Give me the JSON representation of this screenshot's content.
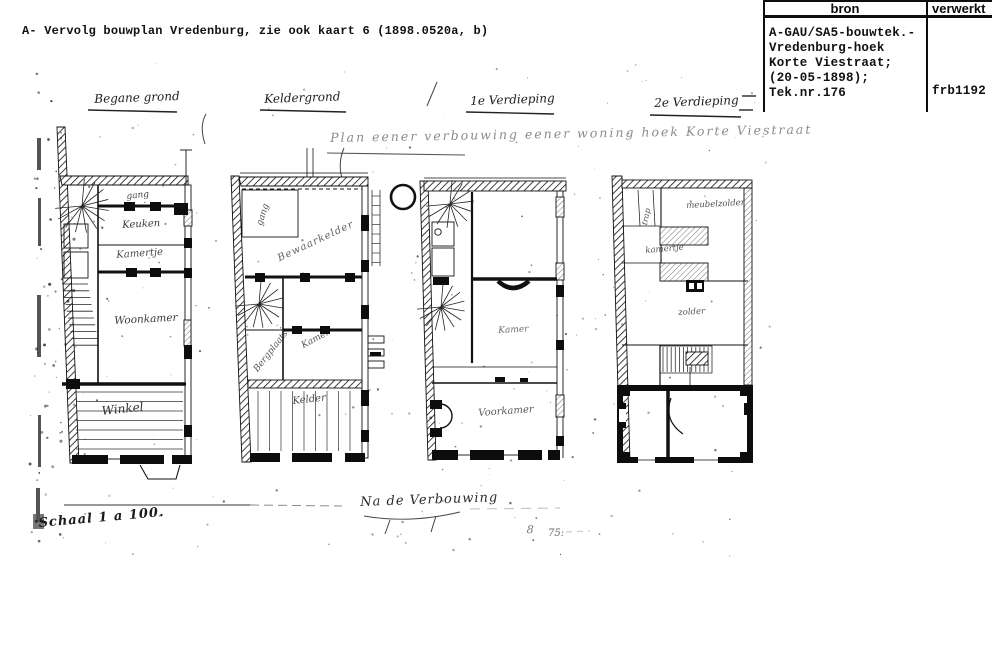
{
  "page": {
    "note": "A- Vervolg bouwplan Vredenburg, zie ook kaart 6 (1898.0520a, b)"
  },
  "catalog_table": {
    "header_bron": "bron",
    "header_verwerkt": "verwerkt",
    "bron_lines": [
      "A-GAU/SA5-bouwtek.-",
      "Vredenburg-hoek",
      "Korte Viestraat;",
      "(20-05-1898);",
      "Tek.nr.176"
    ],
    "verwerkt_value": "frb1192"
  },
  "drawing": {
    "title": "Plan eener verbouwing eener woning hoek Korte Viestraat",
    "floor_labels": [
      "Begane grond",
      "Keldergrond",
      "1e Verdieping",
      "2e Verdieping"
    ],
    "rooms": {
      "p1_gang": "gang",
      "p1_keuken": "Keuken",
      "p1_kamertje": "Kamertje",
      "p1_woonkamer": "Woonkamer",
      "p1_winkel": "Winkel",
      "p2_gang": "gang",
      "p2_bewaarkelder": "Bewaarkelder",
      "p2_kamer": "Kamer",
      "p2_bergplaats": "Bergplaats",
      "p2_kelder": "Kelder",
      "p3_kamer": "Kamer",
      "p3_voorkamer": "Voorkamer",
      "p4_meubelzolder": "meubelzolder",
      "p4_kamertje": "kamertje",
      "p4_zolder": "zolder",
      "p4_trap": "trap"
    },
    "annotations": {
      "after": "Na de Verbouwing",
      "scale": "Schaal 1 a 100.",
      "mark8": "8",
      "mark75": "75:"
    }
  }
}
